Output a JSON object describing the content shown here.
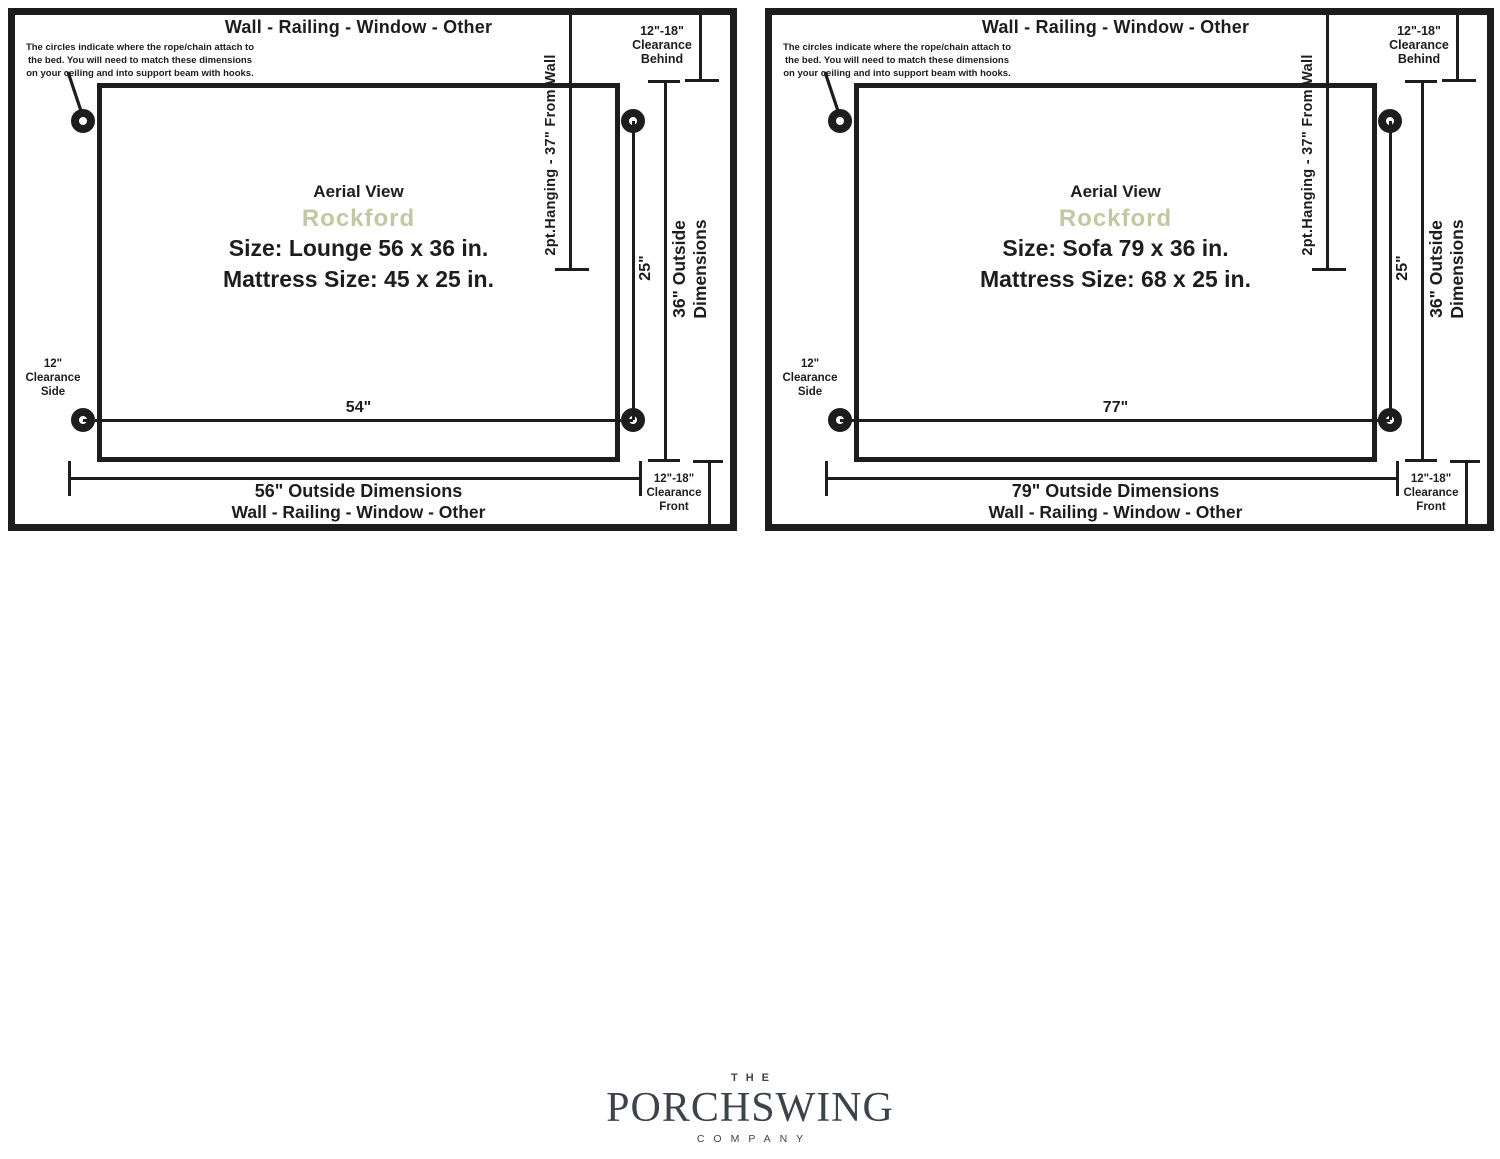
{
  "colors": {
    "ink": "#1d1d1d",
    "model_accent": "#c3c8a3",
    "logo_gray": "#3e434b"
  },
  "panels": [
    {
      "wall_label_top": "Wall - Railing - Window - Other",
      "annotation_line1": "The circles indicate where the rope/chain attach to",
      "annotation_line2": "the bed. You will need to match these dimensions",
      "annotation_line3": "on your ceiling and into support beam with hooks.",
      "hanging_label": "2pt.Hanging - 37\" From Wall",
      "clearance_behind_value": "12\"-18\"",
      "clearance_behind_l2": "Clearance",
      "clearance_behind_l3": "Behind",
      "clearance_side_value": "12\"",
      "clearance_side_l2": "Clearance",
      "clearance_side_l3": "Side",
      "clearance_front_value": "12\"-18\"",
      "clearance_front_l2": "Clearance",
      "clearance_front_l3": "Front",
      "aerial_view": "Aerial View",
      "model": "Rockford",
      "size": "Size: Lounge 56 x 36 in.",
      "mattress": "Mattress Size: 45 x 25 in.",
      "inner_width": "54\"",
      "inner_depth": "25\"",
      "outer_depth_l1": "36\" Outside",
      "outer_depth_l2": "Dimensions",
      "outer_width": "56\" Outside Dimensions",
      "wall_label_bottom": "Wall - Railing - Window - Other"
    },
    {
      "wall_label_top": "Wall - Railing - Window - Other",
      "annotation_line1": "The circles indicate where the rope/chain attach to",
      "annotation_line2": "the bed. You will need to match these dimensions",
      "annotation_line3": "on your ceiling and into support beam with hooks.",
      "hanging_label": "2pt.Hanging - 37\" From Wall",
      "clearance_behind_value": "12\"-18\"",
      "clearance_behind_l2": "Clearance",
      "clearance_behind_l3": "Behind",
      "clearance_side_value": "12\"",
      "clearance_side_l2": "Clearance",
      "clearance_side_l3": "Side",
      "clearance_front_value": "12\"-18\"",
      "clearance_front_l2": "Clearance",
      "clearance_front_l3": "Front",
      "aerial_view": "Aerial View",
      "model": "Rockford",
      "size": "Size: Sofa 79 x 36 in.",
      "mattress": "Mattress Size: 68 x 25 in.",
      "inner_width": "77\"",
      "inner_depth": "25\"",
      "outer_depth_l1": "36\" Outside",
      "outer_depth_l2": "Dimensions",
      "outer_width": "79\" Outside Dimensions",
      "wall_label_bottom": "Wall - Railing - Window - Other"
    }
  ],
  "logo": {
    "the": "THE",
    "name": "PORCHSWING",
    "company": "COMPANY"
  }
}
